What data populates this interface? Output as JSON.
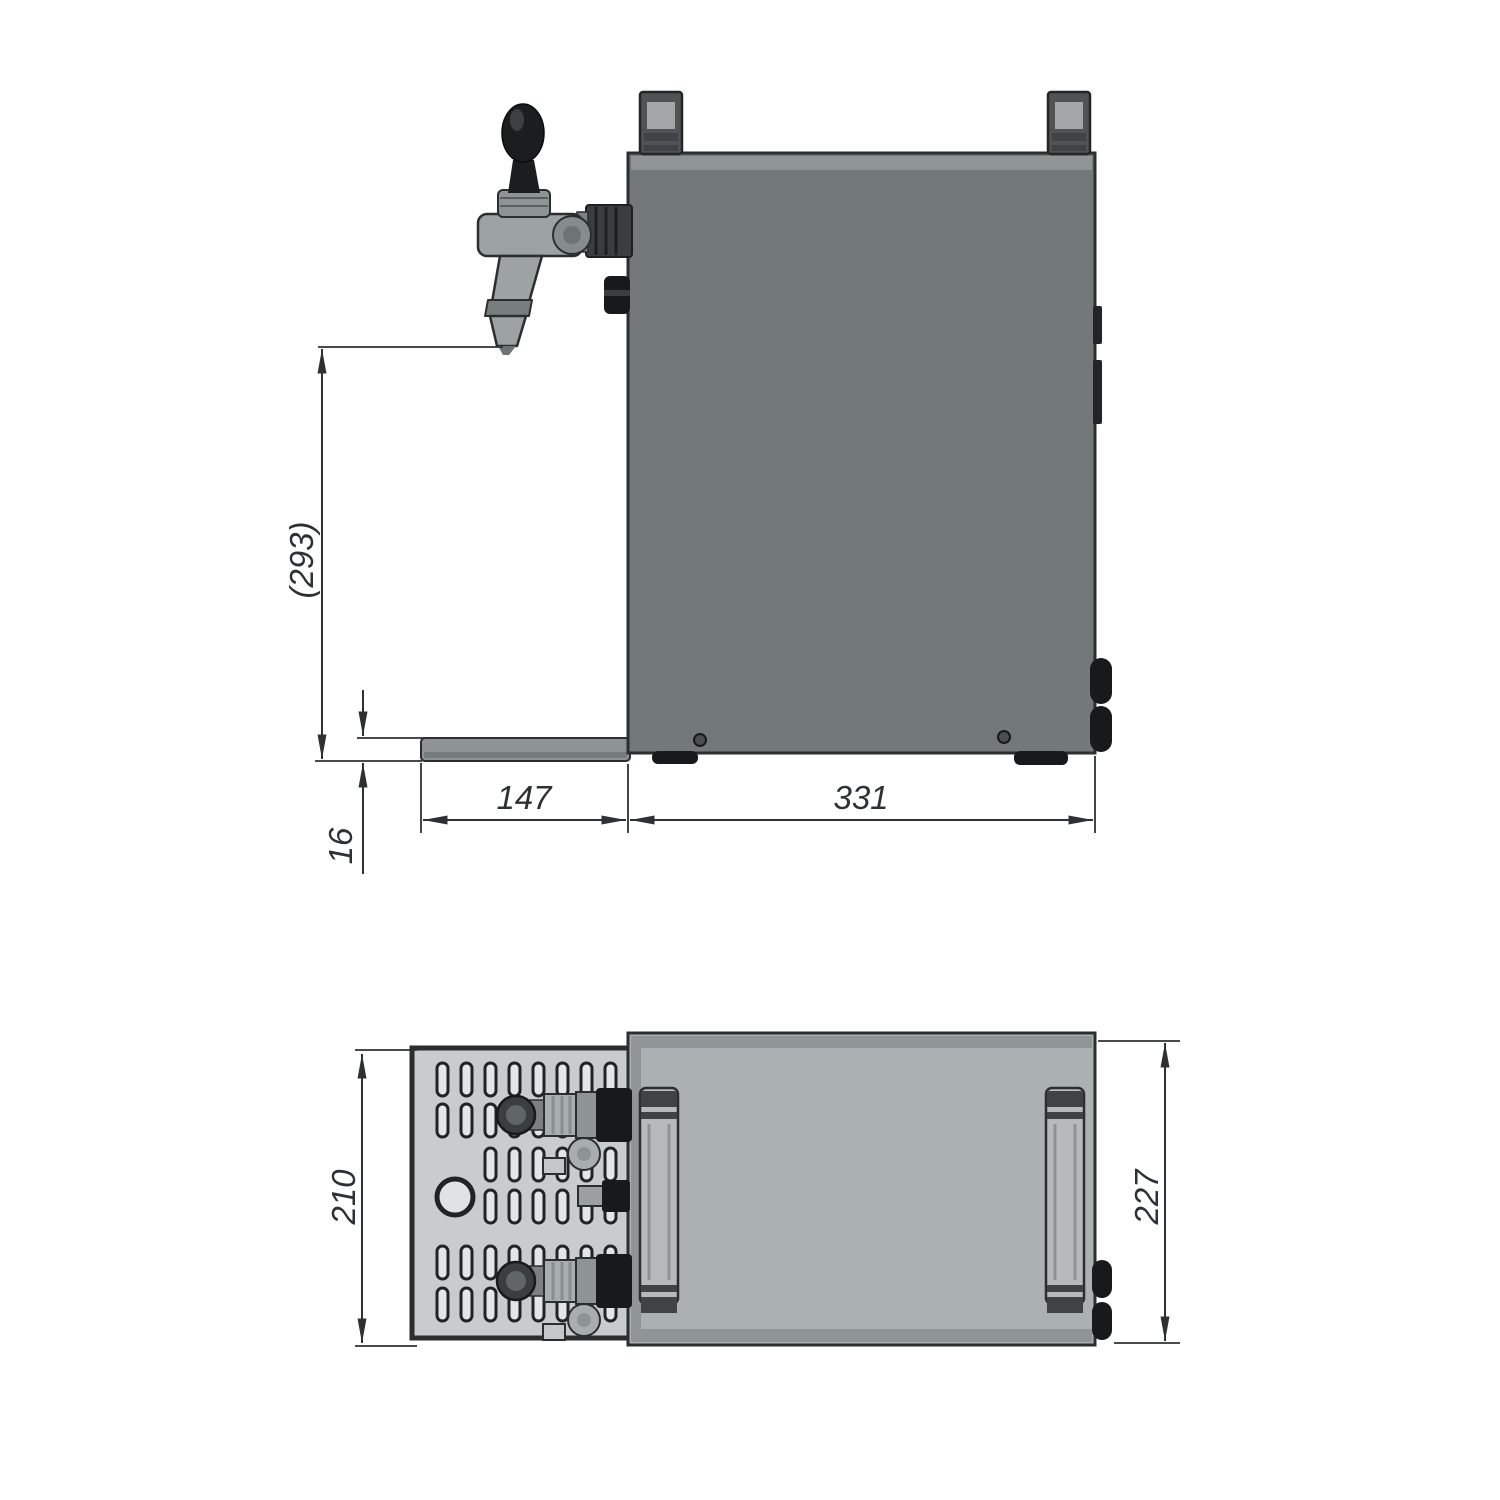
{
  "side_view": {
    "labels": {
      "height": "(293)",
      "tray_thickness": "16",
      "tray_depth": "147",
      "body_depth": "331"
    }
  },
  "top_view": {
    "labels": {
      "tray_width": "210",
      "body_width": "227"
    }
  },
  "colors": {
    "line": "#2e3133",
    "edge": "#2b2e2f",
    "body_side": "#737879",
    "body_top": "#abb0b2",
    "strip": "#8f9495",
    "metal": "#9da2a3",
    "metal_light": "#b6babb",
    "metal_mid": "#8e9394",
    "black_part": "#17191a",
    "dark_band": "#3f4345",
    "grille_bg": "#c9cccd",
    "slot_fill": "#e3e5e6",
    "slot_edge": "#212425",
    "background": "#ffffff"
  }
}
